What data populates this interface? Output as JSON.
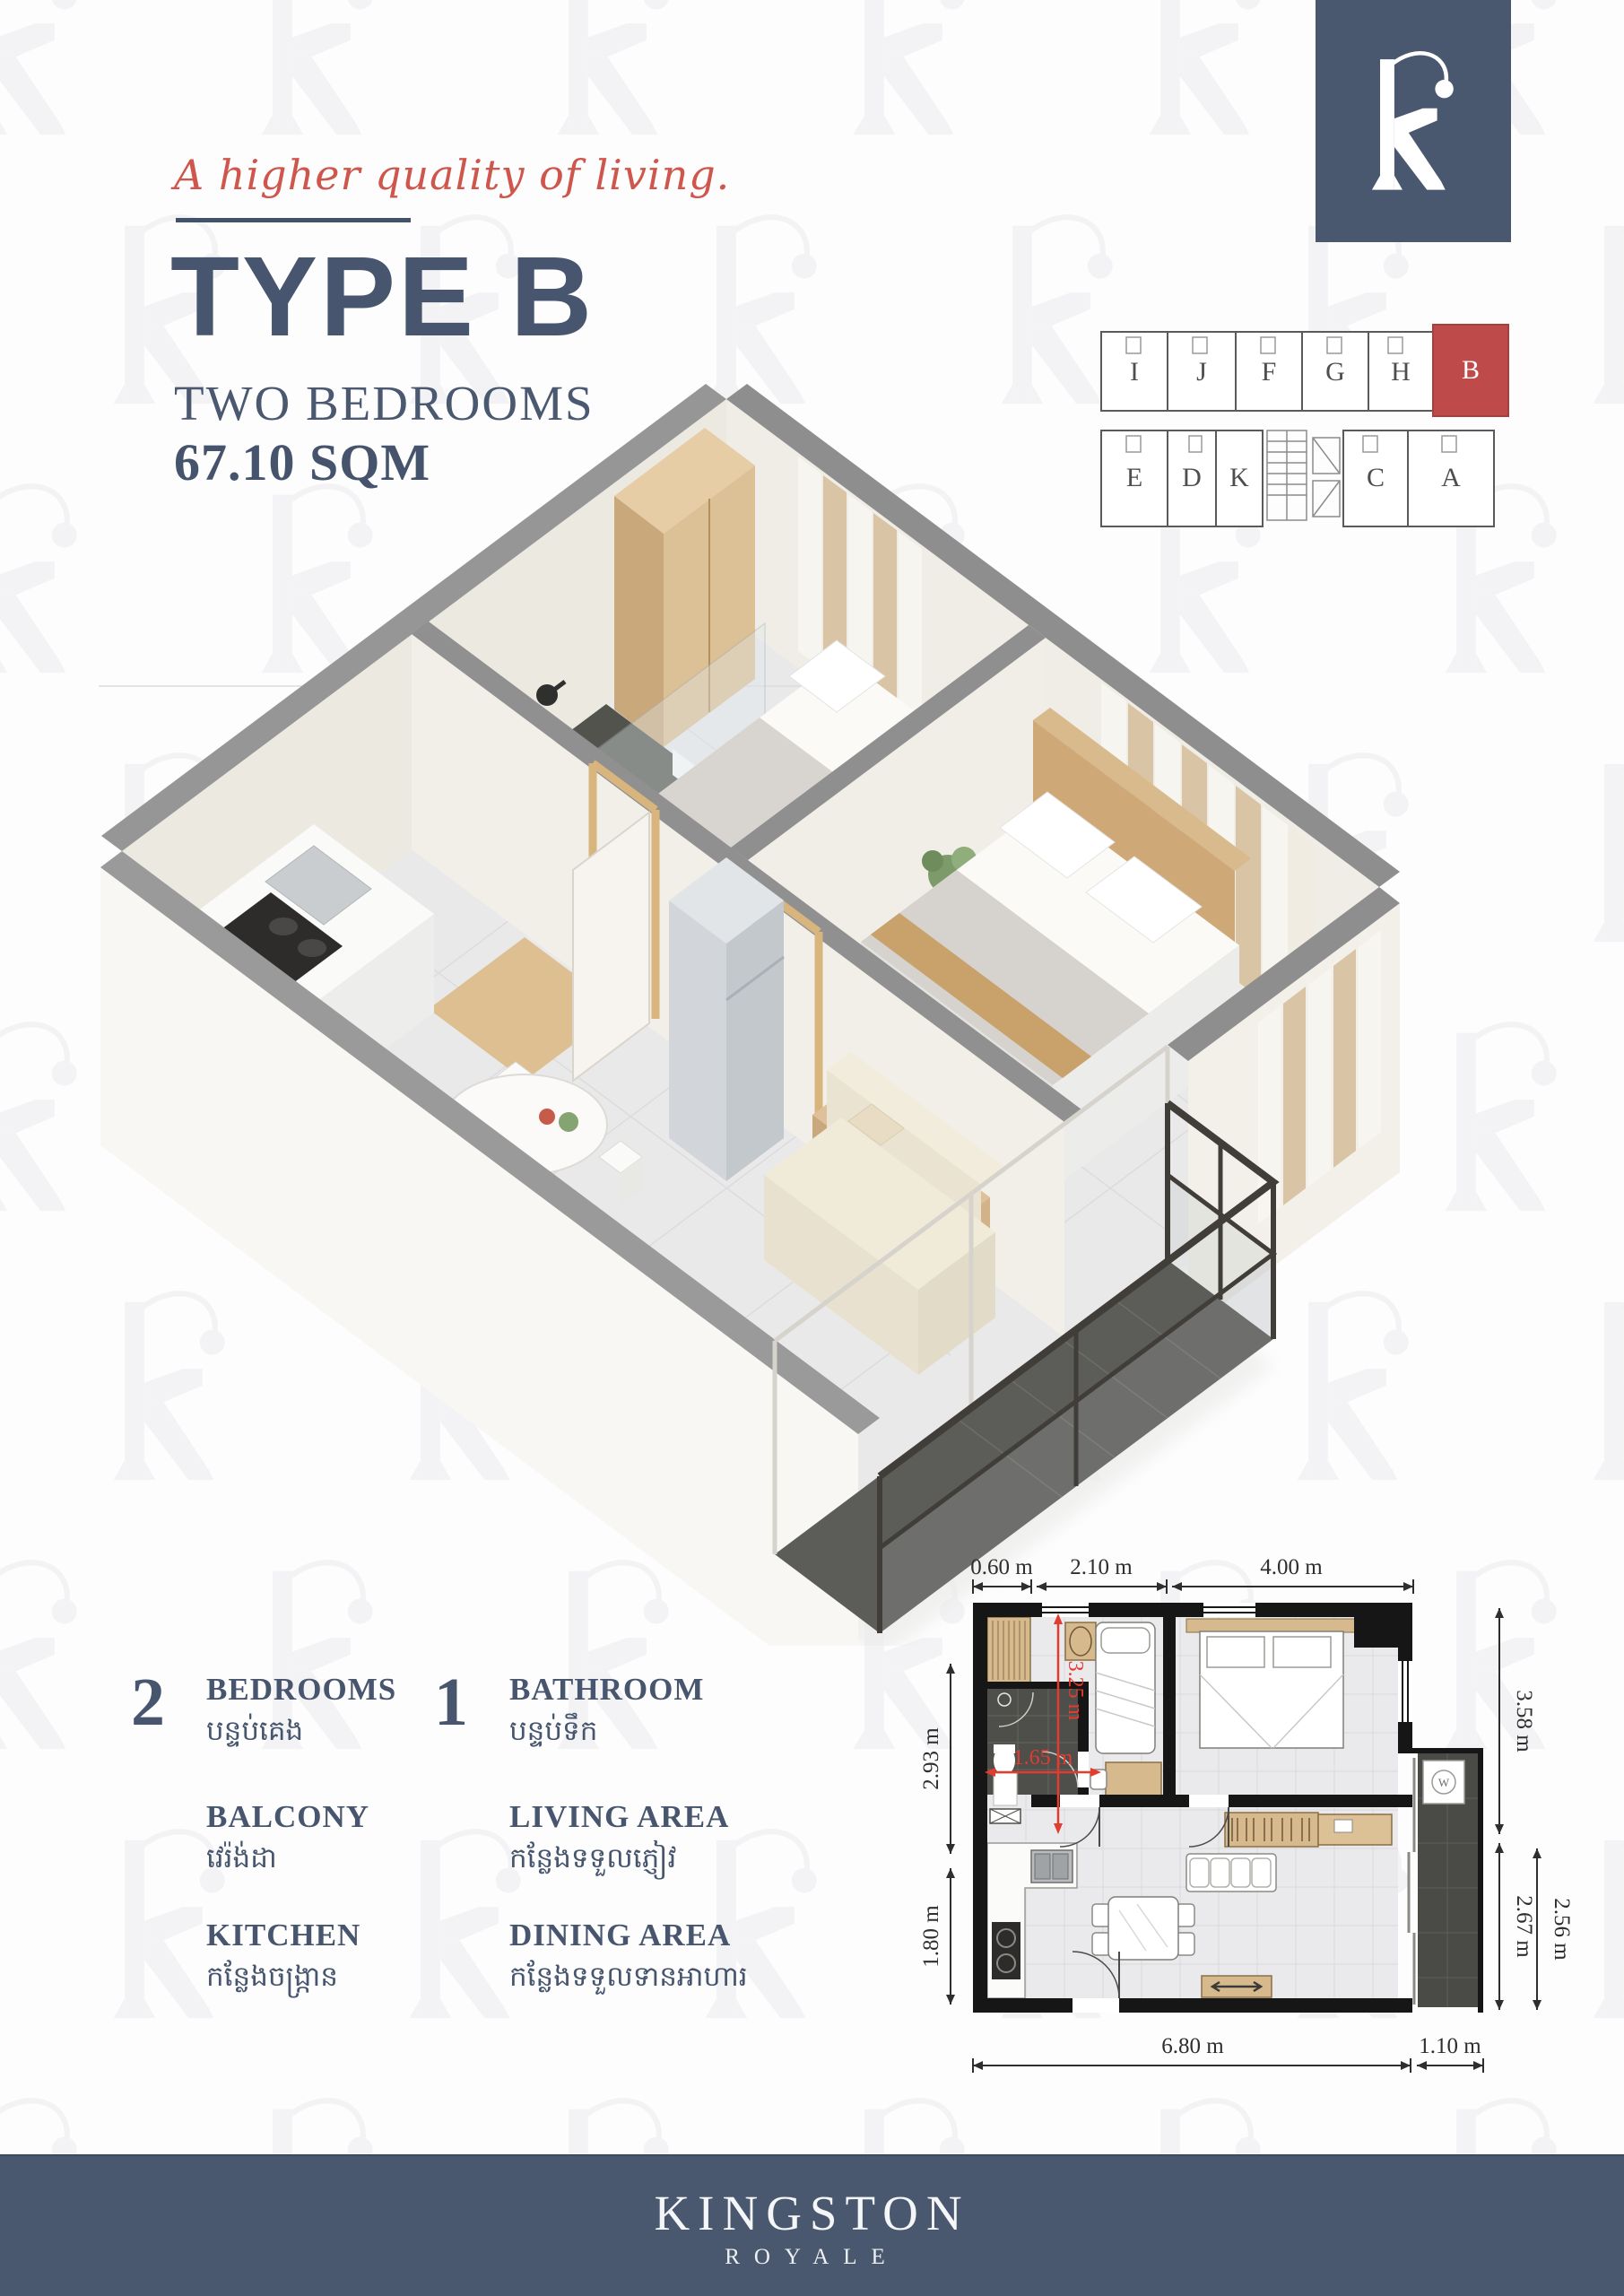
{
  "header": {
    "tagline": "A higher quality of living.",
    "title": "TYPE B",
    "subtitle": "TWO BEDROOMS",
    "area": "67.10 SQM"
  },
  "unit_plate": {
    "highlighted_unit": "B",
    "top_row": [
      "I",
      "J",
      "F",
      "G",
      "H",
      "B"
    ],
    "bottom_row": [
      "E",
      "D",
      "K",
      "C",
      "A"
    ]
  },
  "legend": {
    "items": [
      {
        "count": "2",
        "label": "BEDROOMS",
        "khmer": "បន្ទប់គេង"
      },
      {
        "count": "1",
        "label": "BATHROOM",
        "khmer": "បន្ទប់ទឹក"
      },
      {
        "count": "",
        "label": "BALCONY",
        "khmer": "វេរ៉ង់ដា"
      },
      {
        "count": "",
        "label": "LIVING AREA",
        "khmer": "កន្លែងទទួលភ្ញៀវ"
      },
      {
        "count": "",
        "label": "KITCHEN",
        "khmer": "កន្លែងចង្ក្រាន"
      },
      {
        "count": "",
        "label": "DINING AREA",
        "khmer": "កន្លែងទទួលទានអាហារ"
      }
    ]
  },
  "floor_plan": {
    "dims": {
      "top": [
        "0.60 m",
        "2.10 m",
        "4.00 m"
      ],
      "bottom": [
        "6.80 m",
        "1.10 m"
      ],
      "left": [
        "2.93 m",
        "1.80 m"
      ],
      "right": [
        "3.58 m",
        "2.67 m",
        "2.56 m"
      ],
      "inner": [
        "3.25 m",
        "1.65 m"
      ]
    },
    "washer_label": "W"
  },
  "footer": {
    "brand": "KINGSTON",
    "sub": "ROYALE"
  },
  "palette": {
    "navy": "#47566e",
    "footer_bg": "#4a586f",
    "accent_red": "#cf564c",
    "unit_highlight": "#bf4a4a",
    "dim_red": "#e23b30"
  }
}
